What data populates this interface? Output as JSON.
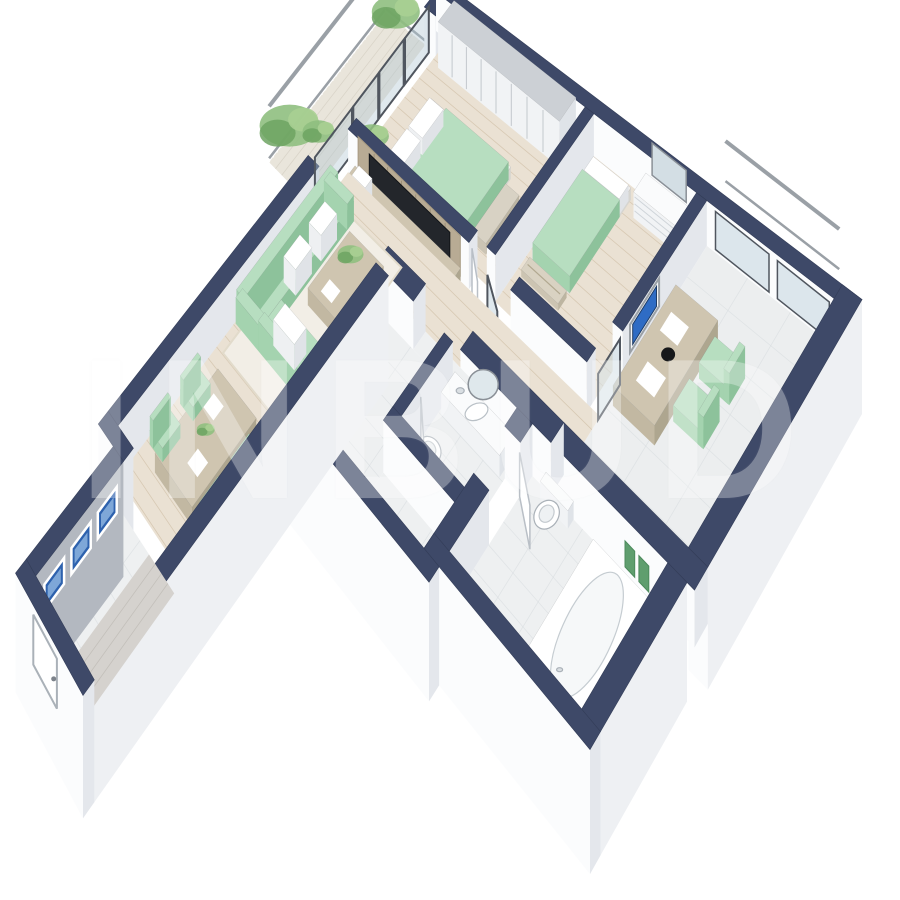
{
  "title": "3D isometric apartment floor plan render",
  "watermark": {
    "text": "INBUD"
  },
  "palette": {
    "wall_cut": "#3e4968",
    "wall_cut_edge": "#333d58",
    "face_white": "#fbfcfd",
    "face_shade": "#e4e7ec",
    "face_ext": "#eef0f3",
    "face_dark_gray": "#b3b8c0",
    "floor_wood": "#eae1d3",
    "floor_wood_line": "#cbb99e",
    "floor_tile": "#eef0f1",
    "floor_tile_line": "#d7dcdf",
    "floor_graywood": "#d5d2ce",
    "floor_graywood_line": "#b7b3ad",
    "floor_office": "#eceeef",
    "balcony_floor": "#e9e5db",
    "rug": "#f2eee6",
    "sofa_top": "#b7dec0",
    "sofa_v": "#a4d3af",
    "sofa_u": "#8dc29b",
    "wood_top": "#cfc5b0",
    "wood_v": "#c2b8a2",
    "wood_u": "#aea68f",
    "white_top": "#fafbfc",
    "white_v": "#f1f3f5",
    "white_u": "#dfe3e8",
    "glass": "rgba(176,198,209,0.40)",
    "frame_dark": "#50565f",
    "window_blue": "#2e62ae",
    "window_blue_light": "#7ea7d8",
    "screen_blue": "#2f6cc4",
    "tv_dark": "#23262b",
    "plant_green": "#8fbf7f",
    "plant_green_dark": "#6da361",
    "towel_green": "#5f9e6e",
    "rail_gray": "#9aa0a6",
    "metal_gray": "#7d838b"
  },
  "rooms": [
    {
      "name": "living-room"
    },
    {
      "name": "master-bedroom"
    },
    {
      "name": "bedroom-2"
    },
    {
      "name": "office"
    },
    {
      "name": "bathroom"
    },
    {
      "name": "wc"
    },
    {
      "name": "hallway"
    },
    {
      "name": "entrance-corridor"
    },
    {
      "name": "balcony"
    },
    {
      "name": "french-balcony"
    }
  ],
  "furniture": [
    "corner-sofa",
    "coffee-table",
    "dining-table",
    "dining-chairs",
    "tv-wall",
    "tv-console",
    "wardrobe",
    "double-bed",
    "bed-bench",
    "single-bed",
    "dresser",
    "mirror",
    "desk",
    "desk-chairs",
    "wall-monitor",
    "bathtub",
    "toilet",
    "vanity-sink",
    "towels",
    "plants",
    "balcony-railing",
    "windows",
    "entry-door"
  ]
}
